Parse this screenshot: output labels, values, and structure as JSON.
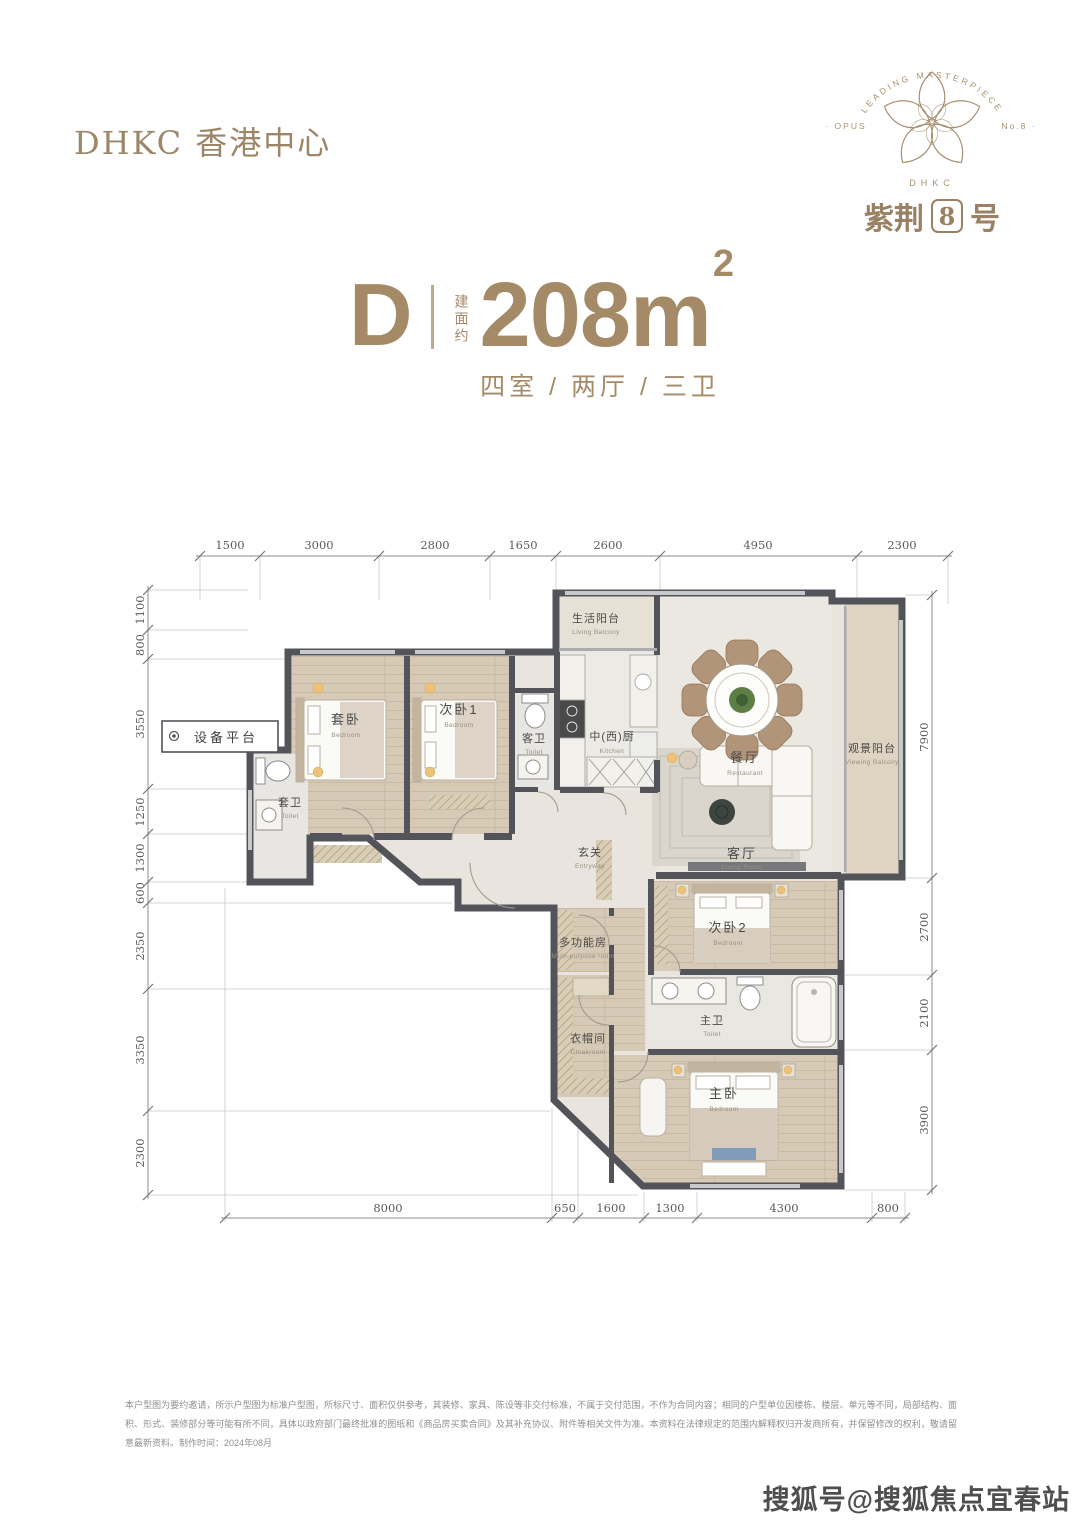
{
  "header": {
    "brand": "DHKC 香港中心"
  },
  "logo": {
    "arc_text": "LEADING MASTERPIECE",
    "left_text": "· OPUS",
    "right_text": "No.8 ·",
    "brand_small": "DHKC",
    "name_prefix": "紫荆",
    "name_number": "8",
    "name_suffix": "号",
    "brand_color": "#a8906f"
  },
  "title": {
    "unit": "D",
    "area_prefix": "建面约",
    "area_value": "208m",
    "area_sup": "2",
    "layout": "四室 / 两厅 / 三卫"
  },
  "plan": {
    "dims": {
      "top": [
        "1500",
        "3000",
        "2800",
        "1650",
        "2600",
        "4950",
        "2300"
      ],
      "left": [
        "1100",
        "800",
        "3550",
        "1250",
        "1300",
        "600",
        "2350",
        "3350",
        "2300"
      ],
      "right": [
        "7900",
        "2700",
        "2100",
        "3900"
      ],
      "bottom": [
        "8000",
        "650",
        "1600",
        "1300",
        "4300",
        "800"
      ]
    },
    "rooms": [
      {
        "cn": "生活阳台",
        "en": "Living Balcony"
      },
      {
        "cn": "套卧",
        "en": "Bedroom"
      },
      {
        "cn": "次卧1",
        "en": "Bedroom"
      },
      {
        "cn": "客卫",
        "en": "Toilet"
      },
      {
        "cn": "中(西)厨",
        "en": "Kitchen"
      },
      {
        "cn": "餐厅",
        "en": "Restaurant"
      },
      {
        "cn": "观景阳台",
        "en": "Viewing Balcony"
      },
      {
        "cn": "客厅",
        "en": "Living Room"
      },
      {
        "cn": "玄关",
        "en": "Entryway"
      },
      {
        "cn": "次卧2",
        "en": "Bedroom"
      },
      {
        "cn": "多功能房",
        "en": "Multi-purpose room"
      },
      {
        "cn": "主卫",
        "en": "Toilet"
      },
      {
        "cn": "衣帽间",
        "en": "Cloakroom"
      },
      {
        "cn": "主卧",
        "en": "Bedroom"
      },
      {
        "cn": "套卫",
        "en": "Toilet"
      }
    ],
    "equipment_platform": "设备平台",
    "wall_color": "#53545a",
    "wood_color": "#d6c9b5"
  },
  "footer": {
    "disclaimer_line1": "本户型图为要约邀请，所示户型图为标准户型图，所标尺寸、面积仅供参考，其装修、家具、陈设等非交付标准，不属于交付范围，不作为合同内容；相同的户型单位因楼栋、楼层、单元等不同，局部结构、面积、形式、装修部分等可能有所不同，具体以",
    "disclaimer_line2": "政府部门最终批准的图纸和《商品房买卖合同》及其补充协议、附件等相关文件为准。本资料在法律规定的范围内解释权归开发商所有，并保留修改的权利，敬请留意最新资料。制作时间：2024年08月"
  },
  "watermark": "搜狐号@搜狐焦点宜春站"
}
